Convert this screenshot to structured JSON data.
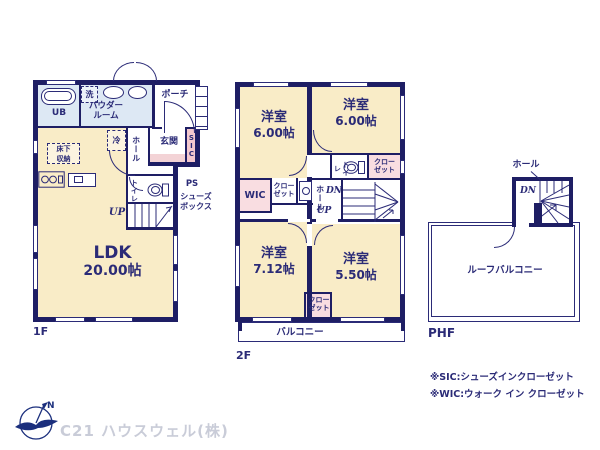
{
  "colors": {
    "wall": "#1e1e64",
    "ink": "#2b2b77",
    "cream": "#f9ecc7",
    "blue": "#dde8f4",
    "pink": "#f9dde1",
    "pink2": "#f3c8ce",
    "tataki": "#f3d3d6",
    "gray": "#c9ccd8"
  },
  "f1": {
    "floor_label": "1F",
    "ldk_name": "LDK",
    "ldk_size": "20.00帖",
    "ub": "UB",
    "washer": "洗",
    "powder": "パウダールーム",
    "porch": "ポーチ",
    "fridge": "冷",
    "hall": "ホール",
    "genkan": "玄関",
    "sic": "SIC",
    "underfloor": "床下収納",
    "toilet": "トイレ",
    "up": "UP",
    "ps": "PS",
    "shoebox": "シューズボックス"
  },
  "f2": {
    "floor_label": "2F",
    "room_nw_name": "洋室",
    "room_nw_size": "6.00帖",
    "room_ne_name": "洋室",
    "room_ne_size": "6.00帖",
    "room_sw_name": "洋室",
    "room_sw_size": "7.12帖",
    "room_se_name": "洋室",
    "room_se_size": "5.50帖",
    "toilet": "トイレ",
    "closet": "クローゼット",
    "wic": "WIC",
    "hall": "ホール",
    "dn": "DN",
    "up": "UP",
    "balcony": "バルコニー"
  },
  "phf": {
    "floor_label": "PHF",
    "hall": "ホール",
    "dn": "DN",
    "roof_balcony": "ルーフバルコニー"
  },
  "notes": [
    "※SIC:シューズインクローゼット",
    "※WIC:ウォーク イン クローゼット"
  ],
  "footer": {
    "company": "C21 ハウスウェル(株)",
    "north": "N"
  }
}
